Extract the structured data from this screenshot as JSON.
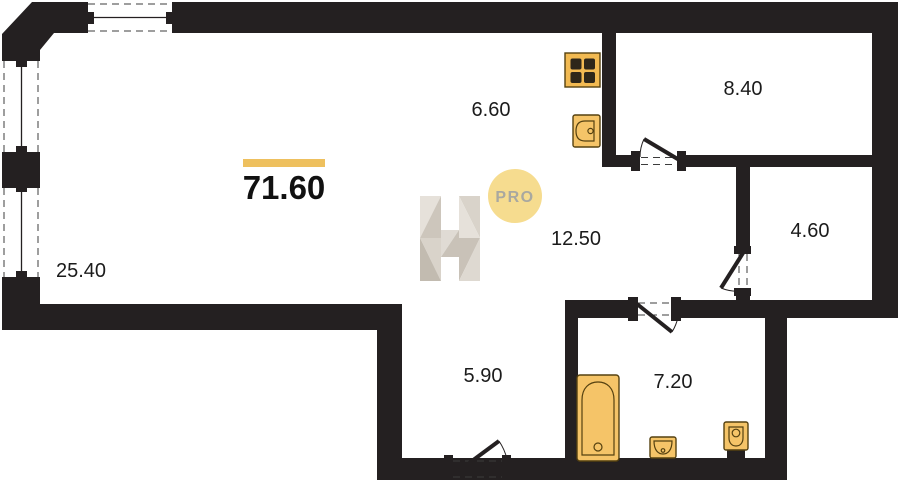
{
  "plan": {
    "type": "apartment-floor-plan",
    "total_area": "71.60",
    "watermark": {
      "letter": "H",
      "badge": "PRO"
    },
    "rooms": [
      {
        "name": "living-room",
        "area": "25.40"
      },
      {
        "name": "kitchen",
        "area": "6.60"
      },
      {
        "name": "room-top-right",
        "area": "8.40"
      },
      {
        "name": "room-right",
        "area": "4.60"
      },
      {
        "name": "hall",
        "area": "12.50"
      },
      {
        "name": "corridor",
        "area": "5.90"
      },
      {
        "name": "bathroom",
        "area": "7.20"
      }
    ],
    "fixtures": [
      "stove",
      "kitchen-sink",
      "bathtub",
      "washbasin",
      "toilet"
    ],
    "colors": {
      "wall": "#242021",
      "fixture_fill": "#f5c468",
      "fixture_stroke": "#554110",
      "accent_bar": "#eec05e",
      "badge_fill": "#f6dc8f",
      "badge_text": "#a9a8a0",
      "watermark_light": "#e3ded7",
      "watermark_dark": "#c6bfb4"
    }
  }
}
